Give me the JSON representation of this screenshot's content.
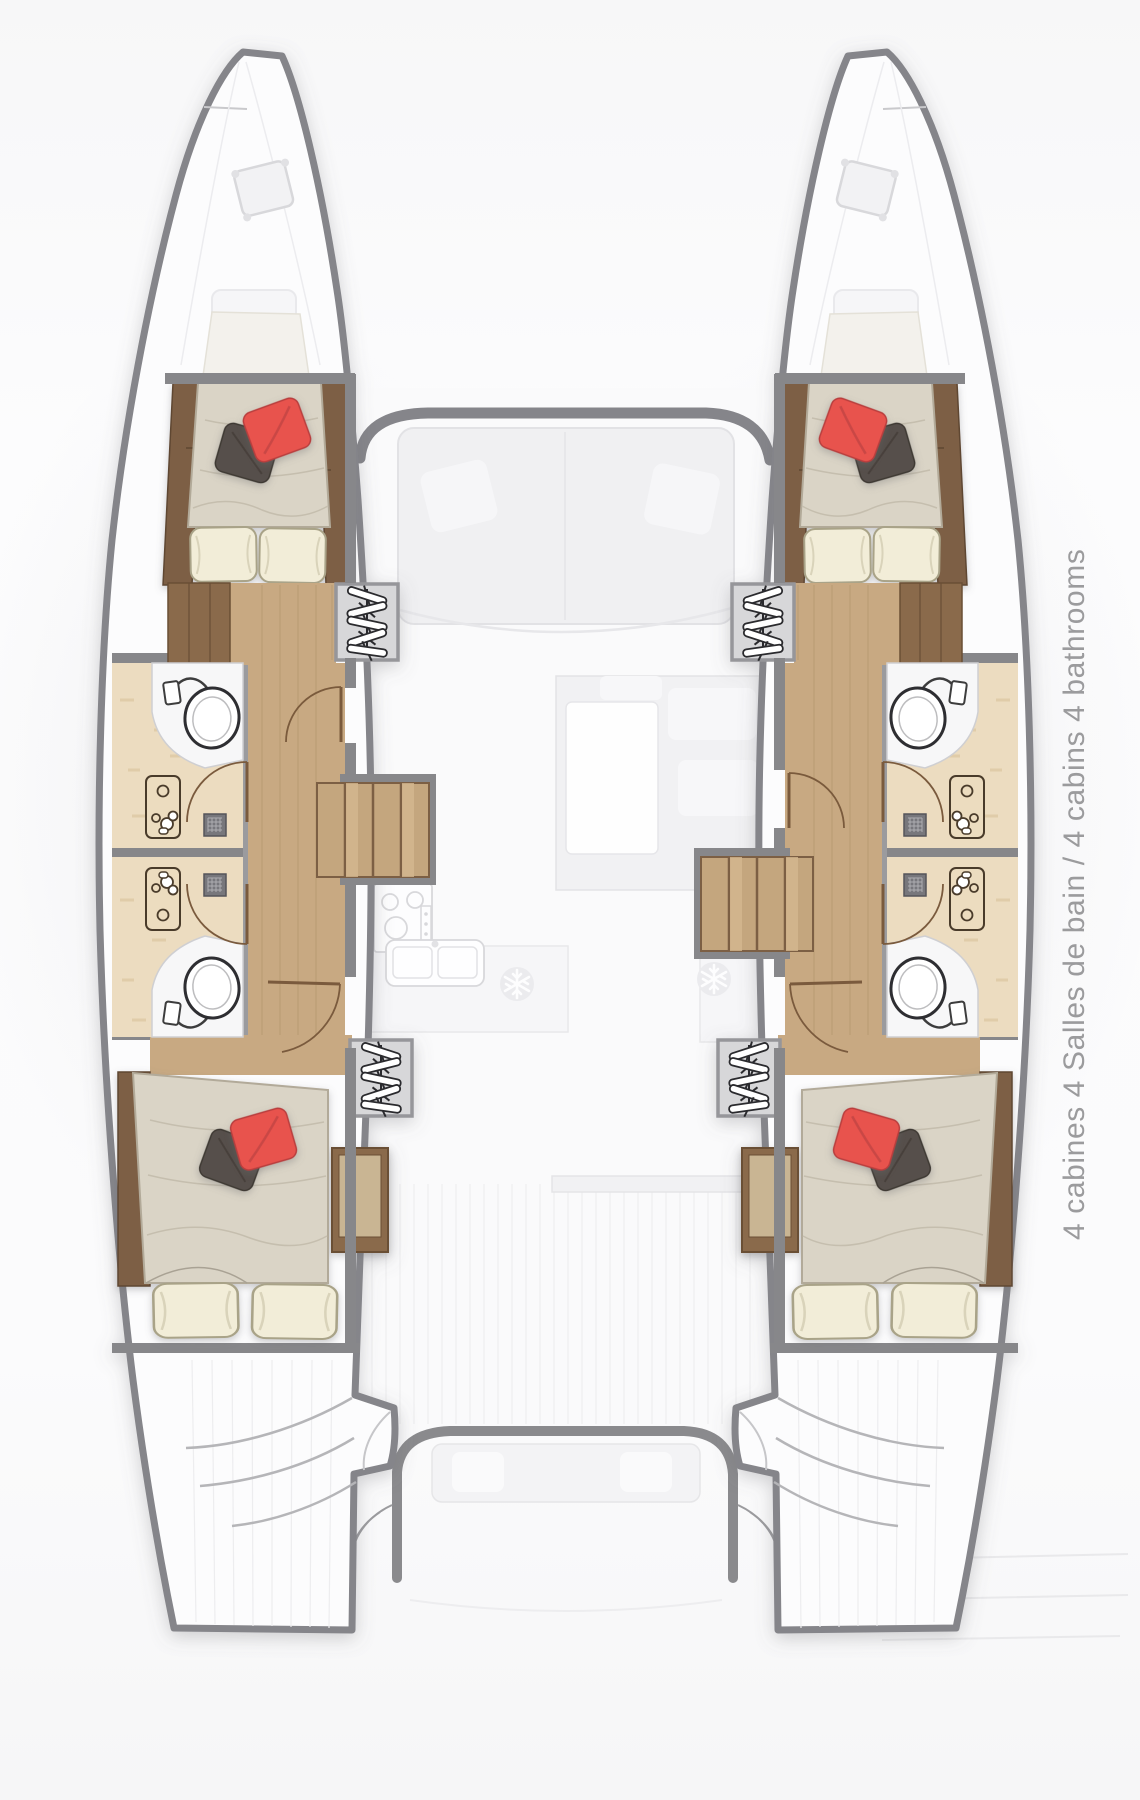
{
  "caption": {
    "text": "4 cabines 4 Salles de bain / 4 cabins 4 bathrooms",
    "color": "#9b9b9d"
  },
  "plan": {
    "cabins_count": 4,
    "bathrooms_count": 4
  },
  "icons": {
    "hanger-icon": "hanging wardrobe locker",
    "snowflake-icon": "refrigerator",
    "toilet-icon": "marine toilet",
    "sink-icon": "washbasin",
    "shower-drain-icon": "shower drain",
    "door-swing-icon": "door swing arc",
    "stove-icon": "galley stove",
    "double-sink-icon": "galley double sink",
    "bed-icon": "double berth"
  },
  "colors": {
    "accent_red": "#e8524e",
    "pillow_dark": "#57504b",
    "pillow_cream": "#f2edd8",
    "mattress": "#dad4c6",
    "wood_dark": "#7d5f45",
    "wood_floor": "#c8a982",
    "steps_wood": "#c4a67e",
    "marble": "#ecdcc0",
    "wall_gray": "#87878a",
    "locker_gray": "#d7d7d9",
    "caption_gray": "#9b9b9d"
  }
}
